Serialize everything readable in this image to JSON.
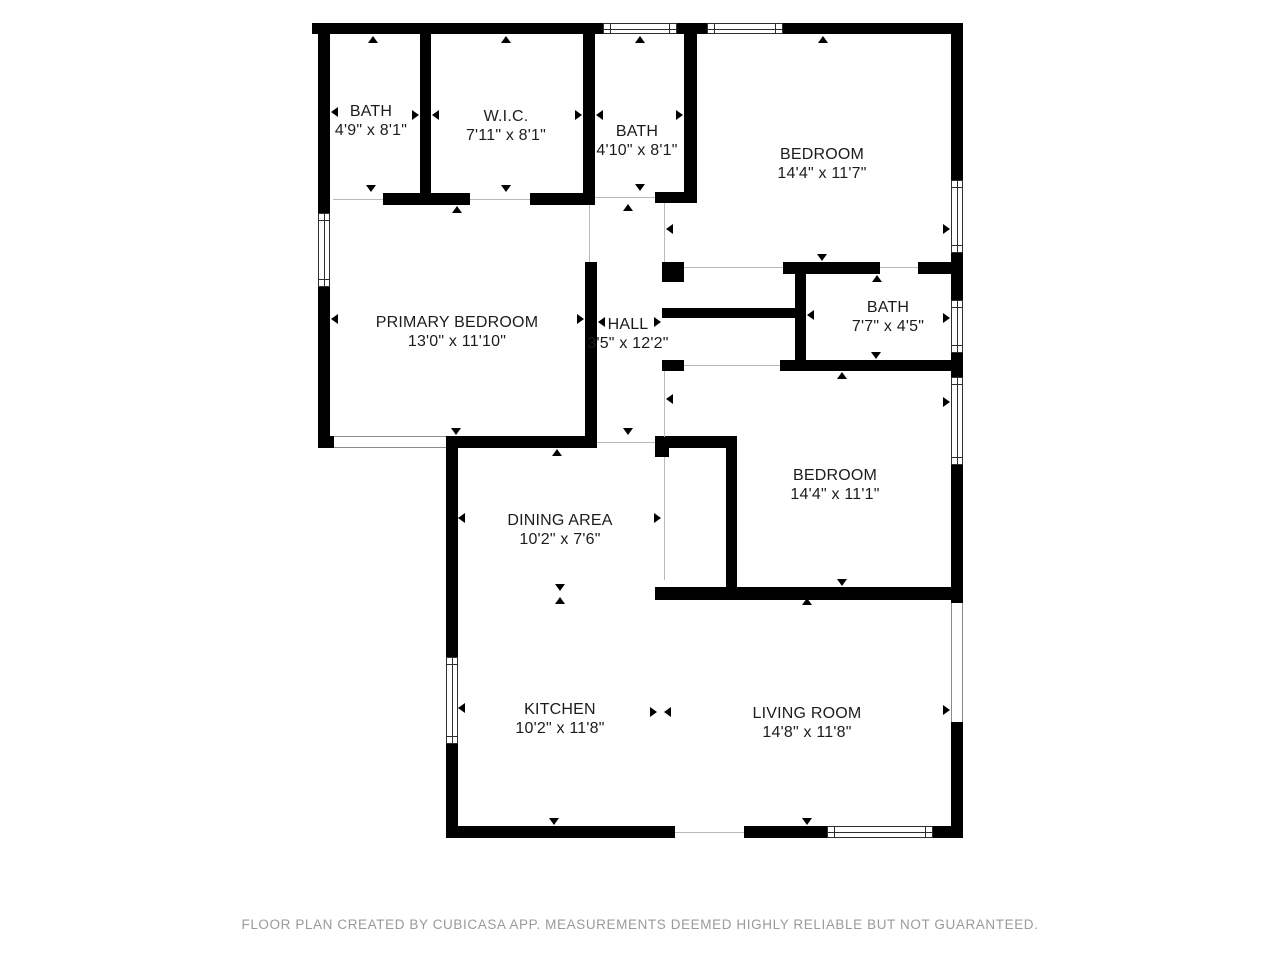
{
  "footer": {
    "text": "FLOOR PLAN CREATED BY CUBICASA APP. MEASUREMENTS DEEMED HIGHLY RELIABLE BUT NOT GUARANTEED."
  },
  "plan": {
    "wall_color": "#000000",
    "background_color": "#ffffff",
    "label_color": "#1c1c1c",
    "footer_color": "#9a9a9a",
    "rooms": [
      {
        "name": "BATH",
        "dims": "4'9\" x 8'1\"",
        "cx": 371,
        "cy": 122
      },
      {
        "name": "W.I.C.",
        "dims": "7'11\" x 8'1\"",
        "cx": 506,
        "cy": 127
      },
      {
        "name": "BATH",
        "dims": "4'10\" x 8'1\"",
        "cx": 637,
        "cy": 142
      },
      {
        "name": "BEDROOM",
        "dims": "14'4\" x 11'7\"",
        "cx": 822,
        "cy": 165
      },
      {
        "name": "PRIMARY BEDROOM",
        "dims": "13'0\" x 11'10\"",
        "cx": 457,
        "cy": 333
      },
      {
        "name": "HALL",
        "dims": "3'5\" x 12'2\"",
        "cx": 628,
        "cy": 335
      },
      {
        "name": "BATH",
        "dims": "7'7\" x 4'5\"",
        "cx": 888,
        "cy": 318
      },
      {
        "name": "BEDROOM",
        "dims": "14'4\" x 11'1\"",
        "cx": 835,
        "cy": 486
      },
      {
        "name": "DINING AREA",
        "dims": "10'2\" x 7'6\"",
        "cx": 560,
        "cy": 531
      },
      {
        "name": "KITCHEN",
        "dims": "10'2\" x 11'8\"",
        "cx": 560,
        "cy": 720
      },
      {
        "name": "LIVING ROOM",
        "dims": "14'8\" x 11'8\"",
        "cx": 807,
        "cy": 724
      }
    ],
    "walls": [
      [
        312,
        23,
        651,
        11
      ],
      [
        318,
        23,
        12,
        190
      ],
      [
        318,
        287,
        12,
        161
      ],
      [
        318,
        436,
        16,
        12
      ],
      [
        446,
        436,
        151,
        12
      ],
      [
        446,
        436,
        12,
        221
      ],
      [
        446,
        744,
        12,
        94
      ],
      [
        446,
        826,
        229,
        12
      ],
      [
        744,
        826,
        83,
        12
      ],
      [
        933,
        826,
        30,
        12
      ],
      [
        951,
        23,
        12,
        157
      ],
      [
        951,
        253,
        12,
        47
      ],
      [
        951,
        353,
        12,
        24
      ],
      [
        951,
        465,
        12,
        138
      ],
      [
        951,
        722,
        12,
        116
      ],
      [
        420,
        34,
        11,
        171
      ],
      [
        583,
        34,
        12,
        171
      ],
      [
        383,
        193,
        87,
        12
      ],
      [
        530,
        193,
        65,
        12
      ],
      [
        684,
        23,
        13,
        180
      ],
      [
        655,
        192,
        42,
        11
      ],
      [
        585,
        262,
        12,
        186
      ],
      [
        662,
        262,
        22,
        20
      ],
      [
        783,
        262,
        97,
        12
      ],
      [
        918,
        262,
        45,
        12
      ],
      [
        662,
        308,
        141,
        10
      ],
      [
        795,
        274,
        11,
        86
      ],
      [
        662,
        360,
        22,
        11
      ],
      [
        780,
        360,
        183,
        11
      ],
      [
        655,
        436,
        82,
        12
      ],
      [
        655,
        436,
        14,
        21
      ],
      [
        726,
        448,
        11,
        149
      ],
      [
        655,
        587,
        308,
        13
      ]
    ],
    "windows": [
      [
        603,
        23,
        74,
        11,
        "h"
      ],
      [
        707,
        23,
        76,
        11,
        "h"
      ],
      [
        318,
        213,
        12,
        74,
        "v"
      ],
      [
        446,
        657,
        12,
        87,
        "v"
      ],
      [
        827,
        826,
        106,
        12,
        "h"
      ],
      [
        951,
        180,
        12,
        73,
        "v"
      ],
      [
        951,
        300,
        12,
        53,
        "v"
      ],
      [
        951,
        377,
        12,
        88,
        "v"
      ]
    ],
    "openings": [
      [
        334,
        436,
        112,
        12,
        "h"
      ],
      [
        951,
        603,
        12,
        119,
        "v"
      ]
    ],
    "thin_lines": [
      [
        589,
        205,
        57,
        "v"
      ],
      [
        664,
        203,
        59,
        "v"
      ],
      [
        684,
        267,
        99,
        "h"
      ],
      [
        664,
        371,
        66,
        "v"
      ],
      [
        664,
        457,
        123,
        "v"
      ],
      [
        333,
        199,
        50,
        "h"
      ],
      [
        470,
        199,
        60,
        "h"
      ],
      [
        595,
        197,
        60,
        "h"
      ],
      [
        597,
        442,
        58,
        "h"
      ],
      [
        684,
        365,
        96,
        "h"
      ],
      [
        880,
        267,
        38,
        "h"
      ],
      [
        675,
        832,
        69,
        "h"
      ]
    ],
    "markers": [
      [
        373,
        36,
        "up"
      ],
      [
        371,
        192,
        "down"
      ],
      [
        331,
        112,
        "left"
      ],
      [
        419,
        115,
        "right"
      ],
      [
        506,
        36,
        "up"
      ],
      [
        506,
        192,
        "down"
      ],
      [
        432,
        115,
        "left"
      ],
      [
        582,
        115,
        "right"
      ],
      [
        640,
        36,
        "up"
      ],
      [
        640,
        191,
        "down"
      ],
      [
        596,
        115,
        "left"
      ],
      [
        683,
        115,
        "right"
      ],
      [
        823,
        36,
        "up"
      ],
      [
        822,
        261,
        "down"
      ],
      [
        666,
        229,
        "left"
      ],
      [
        950,
        229,
        "right"
      ],
      [
        457,
        206,
        "up"
      ],
      [
        456,
        435,
        "down"
      ],
      [
        331,
        319,
        "left"
      ],
      [
        584,
        319,
        "right"
      ],
      [
        628,
        204,
        "up"
      ],
      [
        628,
        435,
        "down"
      ],
      [
        598,
        322,
        "left"
      ],
      [
        661,
        322,
        "right"
      ],
      [
        877,
        275,
        "up"
      ],
      [
        876,
        359,
        "down"
      ],
      [
        807,
        315,
        "left"
      ],
      [
        950,
        318,
        "right"
      ],
      [
        842,
        372,
        "up"
      ],
      [
        842,
        586,
        "down"
      ],
      [
        666,
        399,
        "left"
      ],
      [
        950,
        402,
        "right"
      ],
      [
        557,
        449,
        "up"
      ],
      [
        560,
        591,
        "down"
      ],
      [
        458,
        518,
        "left"
      ],
      [
        661,
        518,
        "right"
      ],
      [
        560,
        597,
        "up"
      ],
      [
        554,
        825,
        "down"
      ],
      [
        458,
        708,
        "left"
      ],
      [
        657,
        712,
        "right"
      ],
      [
        807,
        598,
        "up"
      ],
      [
        807,
        825,
        "down"
      ],
      [
        664,
        712,
        "left"
      ],
      [
        950,
        710,
        "right"
      ]
    ]
  }
}
